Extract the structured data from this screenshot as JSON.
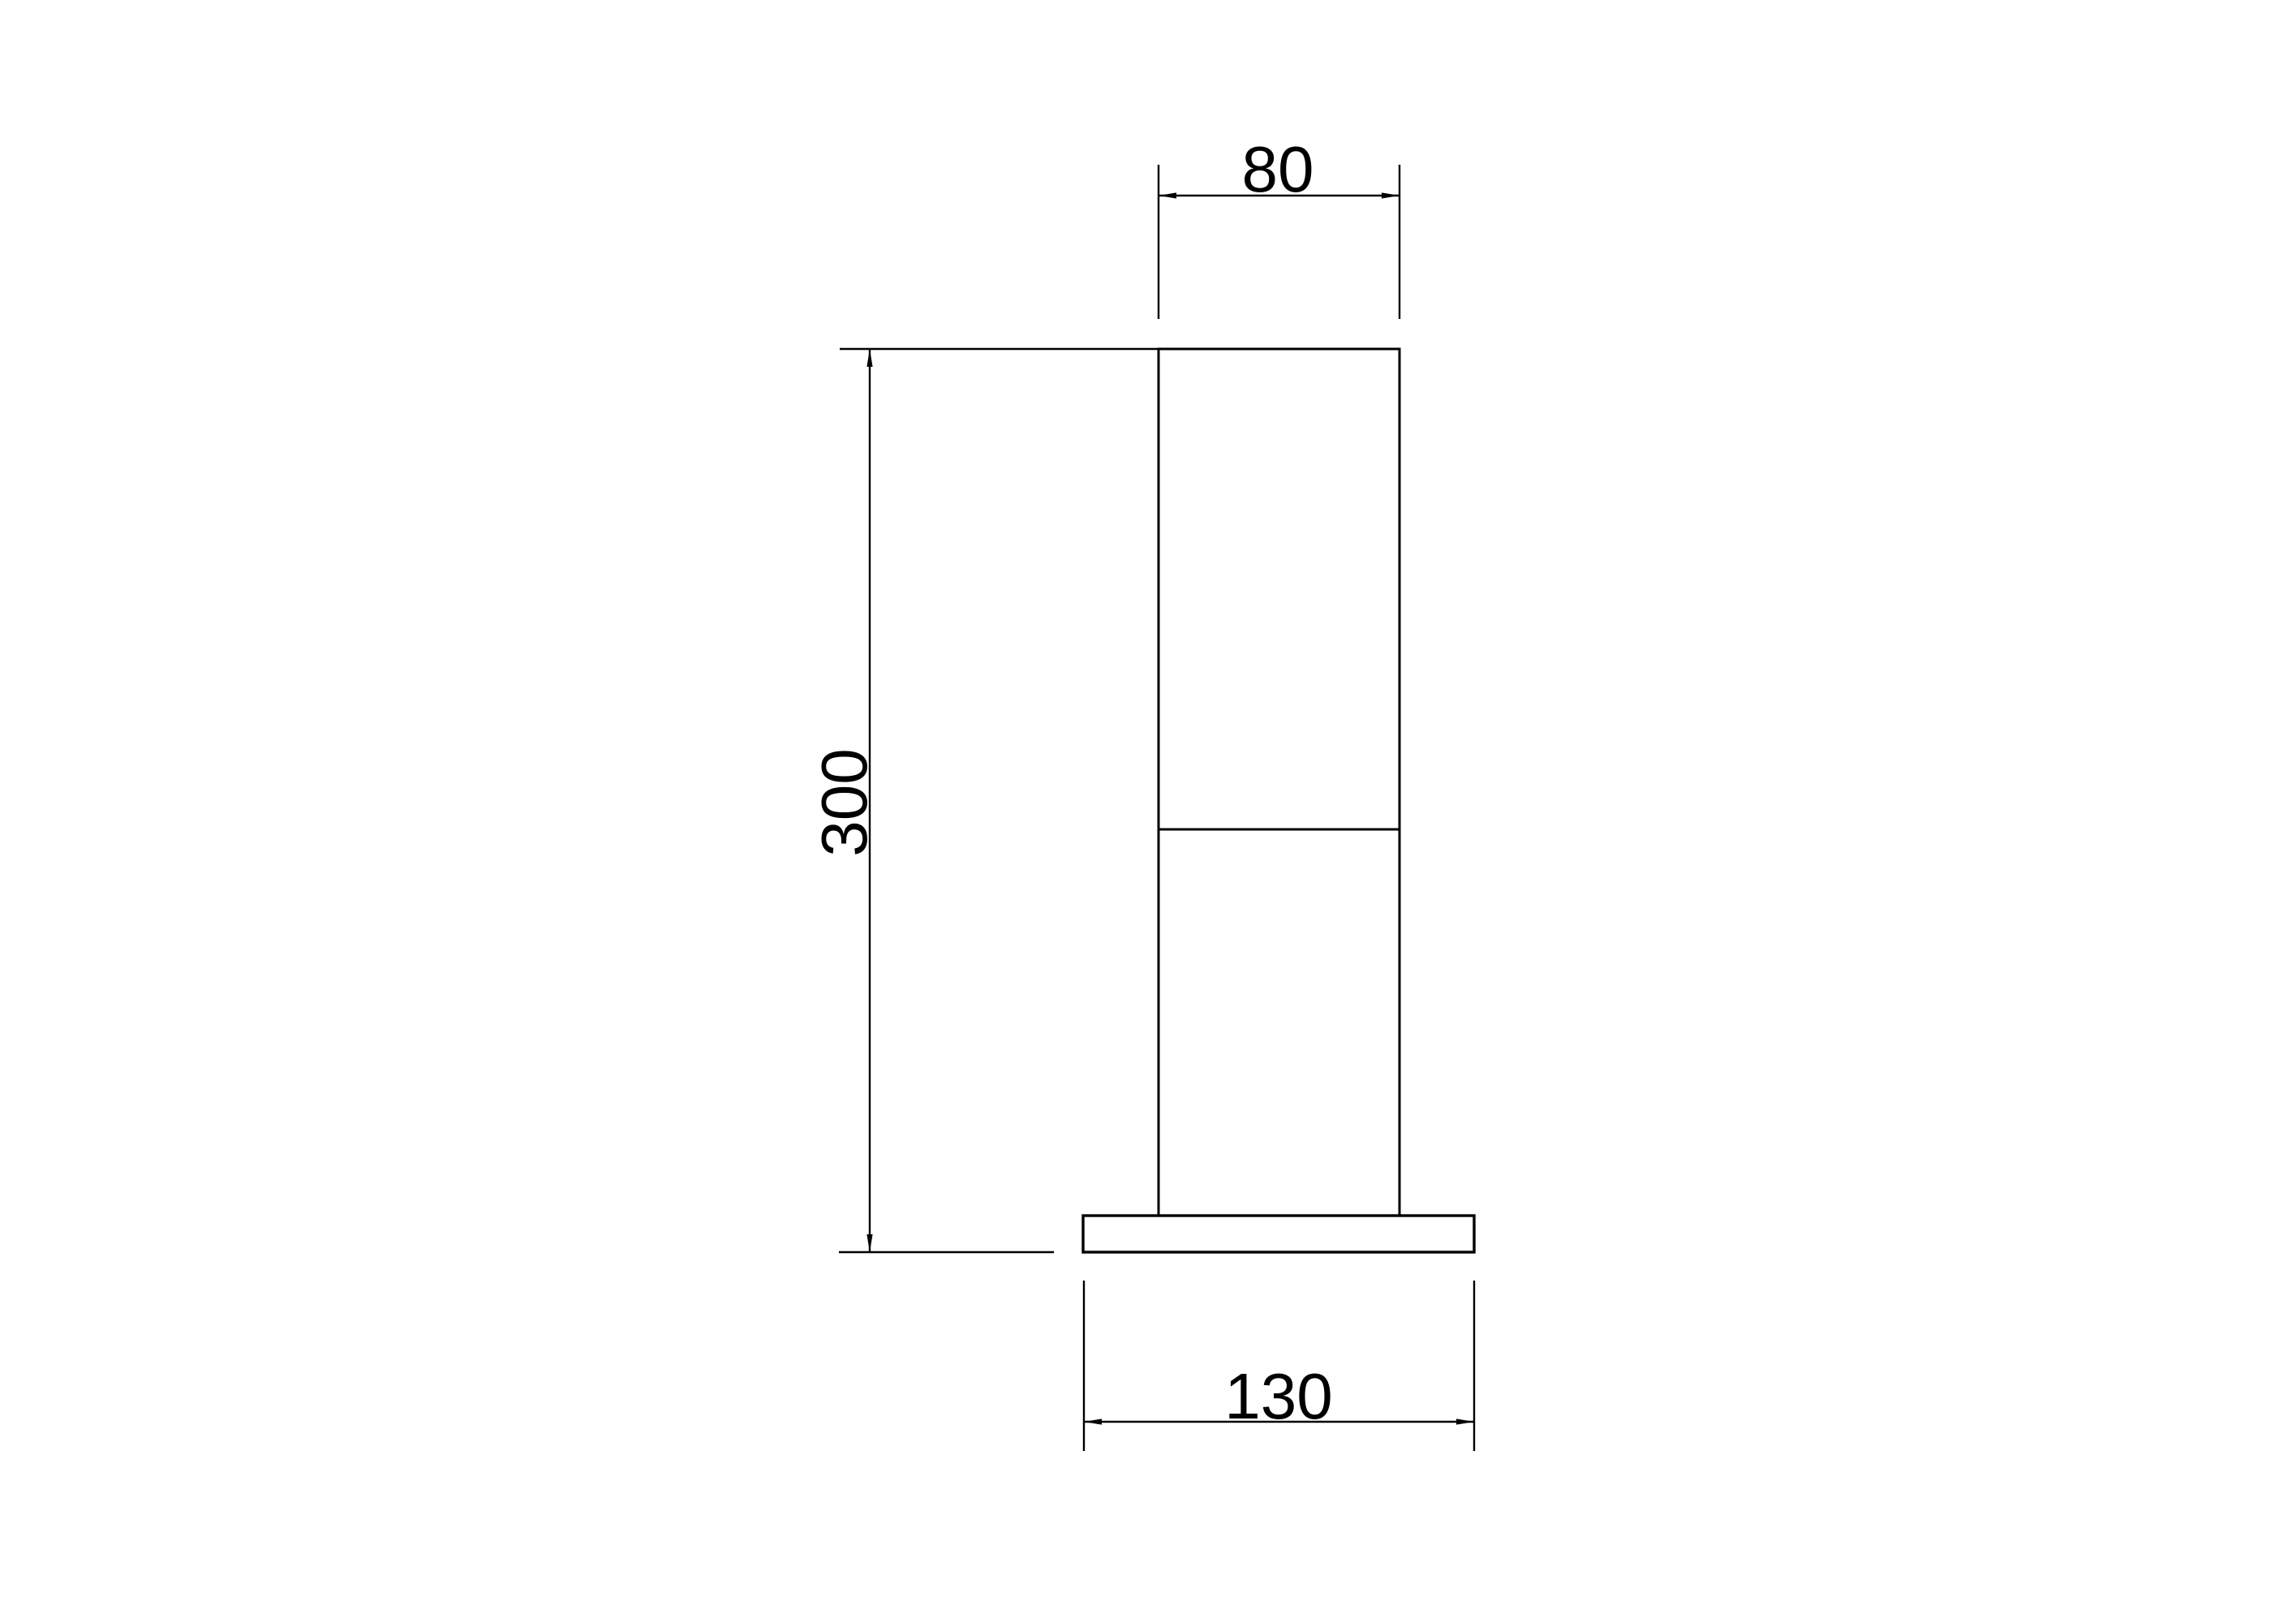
{
  "page": {
    "background_color": "#ffffff"
  },
  "drawing": {
    "kind": "bollard-light-dimension-drawing",
    "line_color": "#000000",
    "dimensions": {
      "top_width": "80",
      "height": "300",
      "base_width": "130"
    }
  }
}
